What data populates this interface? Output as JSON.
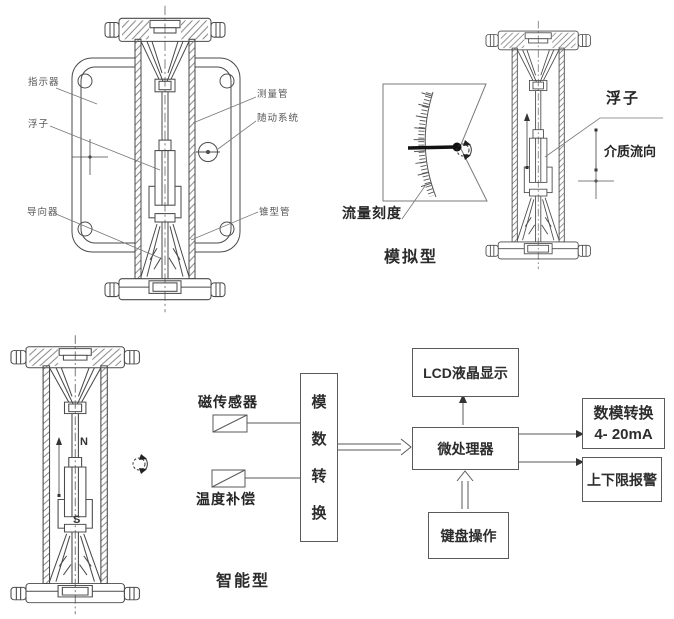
{
  "meter_front": {
    "labels": {
      "indicator": "指示器",
      "float_label": "浮子",
      "guide": "导向器",
      "measuring_tube": "测量管",
      "follow_system": "随动系统",
      "cone_tube": "锥型管"
    }
  },
  "analog_type": {
    "scale_label": "流量刻度",
    "caption": "模拟型",
    "float_label": "浮子",
    "flow_direction": "介质流向"
  },
  "smart_type": {
    "caption": "智能型",
    "pole_n": "N",
    "pole_s": "S",
    "blocks": {
      "magnetic_sensor": "磁传感器",
      "temp_compensation": "温度补偿",
      "ad_convert": "模数转换",
      "lcd": "LCD液晶显示",
      "mcu": "微处理器",
      "keyboard": "键盘操作",
      "da_line1": "数模转换",
      "da_line2": "4- 20mA",
      "alarm": "上下限报警"
    }
  },
  "colors": {
    "line": "#4a4a4a",
    "text": "#2d2d2d",
    "needle": "#111111",
    "background": "#ffffff"
  }
}
